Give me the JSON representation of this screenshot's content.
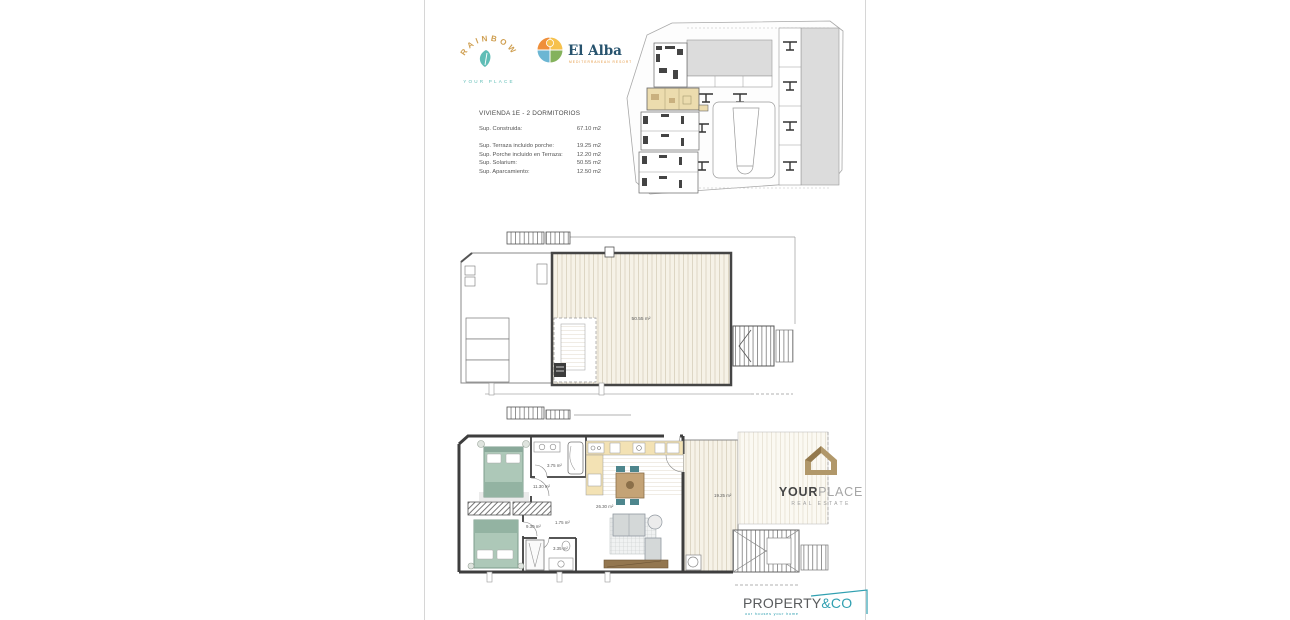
{
  "logos": {
    "rainbow": {
      "name": "RAINBOW",
      "subtitle": "YOUR PLACE",
      "gold": "#cf9f51",
      "teal": "#5fbdb6"
    },
    "elalba": {
      "name": "El Alba",
      "subtitle": "MEDITERRANEAN RESORT",
      "navy": "#27536e",
      "orange": "#e59a45"
    },
    "yourplace": {
      "word1": "YOUR",
      "word2": "PLACE",
      "subtitle": "REAL ESTATE",
      "gold": "#b1986a"
    },
    "propertyco": {
      "word1": "PROPERTY",
      "word2": "&CO",
      "tagline": "our houses your home",
      "teal": "#31a0b1",
      "dark": "#595b5d"
    }
  },
  "specs": {
    "title": "VIVIENDA 1E - 2 DORMITORIOS",
    "rows": [
      {
        "label": "Sup. Construida:",
        "value": "67.10 m2"
      },
      {
        "label": "Sup. Terraza incluido porche:",
        "value": "19.25 m2"
      },
      {
        "label": "Sup. Porche incluido en Terraza:",
        "value": "12.20 m2"
      },
      {
        "label": "Sup. Solarium:",
        "value": "50.55 m2"
      },
      {
        "label": "Sup. Aparcamiento:",
        "value": "12.50 m2"
      }
    ]
  },
  "solarium_plan": {
    "area_label": "50.55 m²"
  },
  "floor_plan": {
    "bedroom1_area": "11.30 m²",
    "bathroom1_area": "3.75 m²",
    "bedroom2_area": "9.30 m²",
    "hall_area": "1.75 m²",
    "bathroom2_area": "3.35 m²",
    "living_area": "26.30 m²",
    "terrace_area": "19.25 m²"
  },
  "site_plan": {
    "highlight_color": "#ecdcae",
    "building_color": "#dcdcdc"
  }
}
